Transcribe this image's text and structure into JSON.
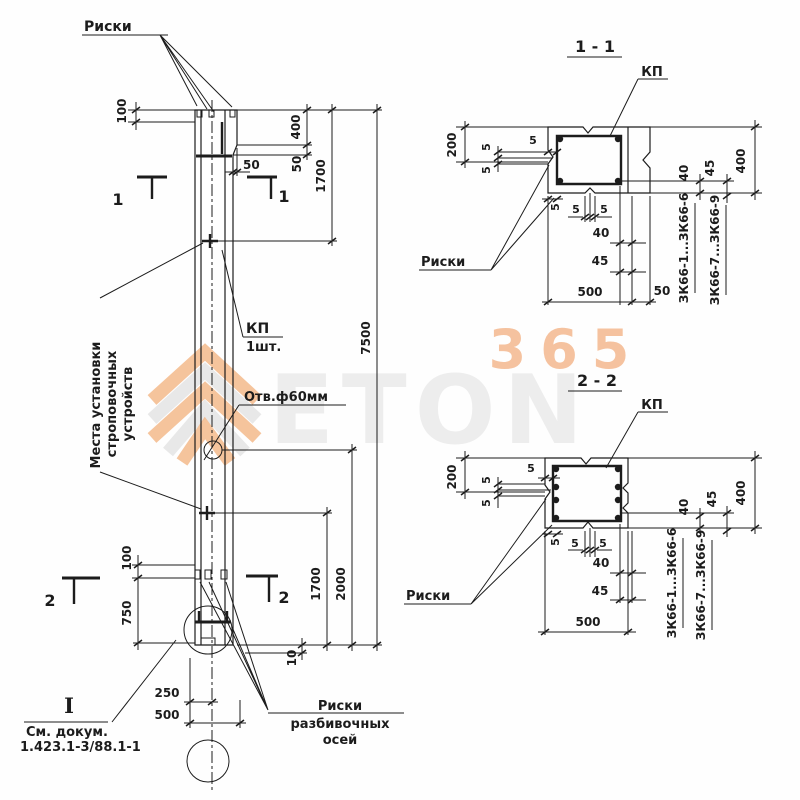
{
  "page": {
    "background": "#fefefe",
    "ink": "#1c1c1c"
  },
  "watermark": {
    "digits": "365",
    "word": "ETON",
    "orange": "#f2a86e",
    "light_orange": "#f3b183",
    "gray": "#ececec"
  },
  "dims": {
    "d5": "5",
    "d10": "10",
    "d40": "40",
    "d45": "45",
    "d50": "50",
    "d100": "100",
    "d200": "200",
    "d250": "250",
    "d400": "400",
    "d500": "500",
    "d750": "750",
    "d1700": "1700",
    "d2000": "2000",
    "d7500": "7500"
  },
  "labels": {
    "riski": "Риски",
    "kp": "КП",
    "kp_qty": "1шт.",
    "hole": "Отв.ф60мм",
    "strop_line1": "Места установки",
    "strop_line2": "строповочных",
    "strop_line3": "устройств",
    "detail_mark": "I",
    "see_doc": "См. докум.",
    "doc_number": "1.423.1-3/88.1-1",
    "axes_line1": "Риски",
    "axes_line2": "разбивочных",
    "axes_line3": "осей",
    "mark1": "1",
    "mark2": "2",
    "section1_title": "1 - 1",
    "section2_title": "2 - 2",
    "series_a": "ЗК66-1...ЗК66-6",
    "series_b": "ЗК66-7...ЗК66-9"
  }
}
